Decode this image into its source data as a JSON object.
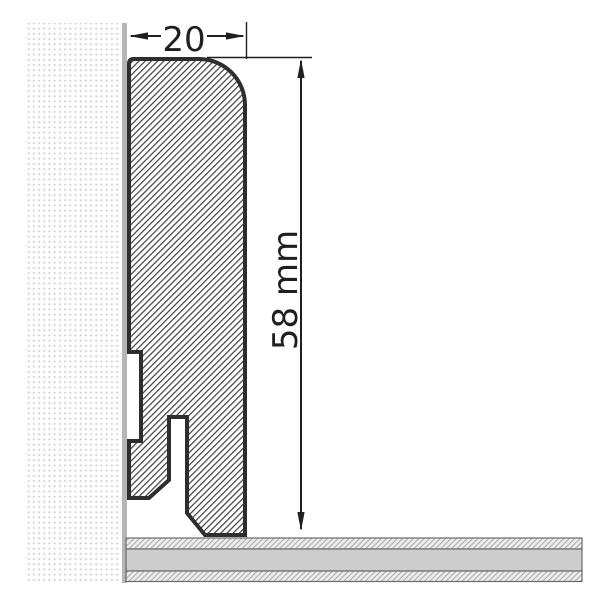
{
  "drawing": {
    "type": "skirting-board-cross-section",
    "width_label": "20",
    "height_label": "58 mm"
  },
  "colors": {
    "background": "#ffffff",
    "outline": "#2e2e2e",
    "hatch_line": "#474747",
    "dimension": "#1f1f1f",
    "wall_dot": "#c9c9c9",
    "wall_strip": "#b6b6b6",
    "floor_gray": "#cdcdcd",
    "floor_hatch_bg": "#ececec",
    "floor_hatch_line": "#a9a9a9",
    "floor_outline": "#6a6a6a"
  }
}
